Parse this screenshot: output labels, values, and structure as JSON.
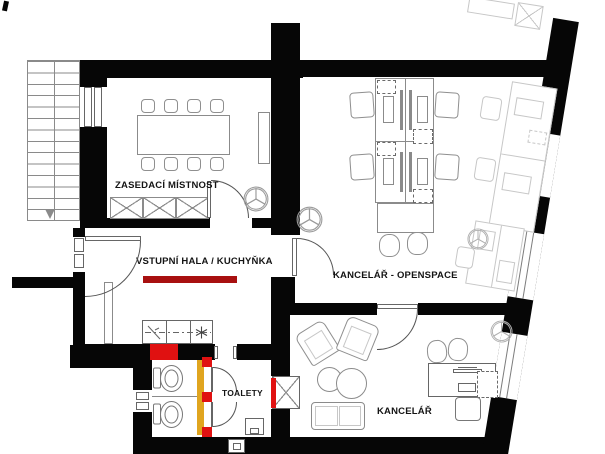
{
  "drawing": {
    "type": "office floor plan",
    "rooms": [
      {
        "id": "meeting-room",
        "label": "ZASEDACÍ MÍSTNOST"
      },
      {
        "id": "entrance-hall-kitchenette",
        "label": "VSTUPNÍ HALA / KUCHYŇKA"
      },
      {
        "id": "openspace-office",
        "label": "KANCELÁŘ - OPENSPACE"
      },
      {
        "id": "toilets",
        "label": "TOALETY"
      },
      {
        "id": "office",
        "label": "KANCELÁŘ"
      }
    ],
    "colors": {
      "wall": "#060606",
      "red": "#e01111",
      "dark_red": "#a81010",
      "yellow": "#e0a51f",
      "furniture": "#8b8b8b",
      "faint": "#c7c7c7"
    }
  }
}
